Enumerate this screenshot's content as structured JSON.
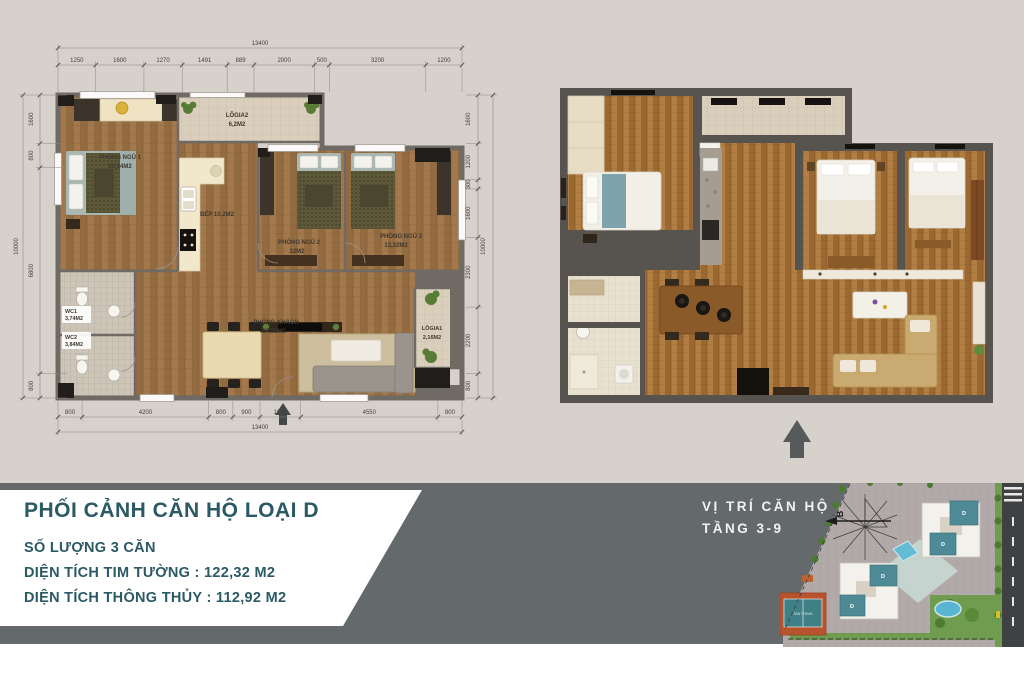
{
  "colors": {
    "canvas_bg": "#d7d1cc",
    "band": "#64696c",
    "title": "#2b5964",
    "wall_2d": "#6f6a64",
    "wall_3d": "#57534e",
    "unit_teal": "#4e8a96"
  },
  "plan2d": {
    "rooms": {
      "bedroom1": {
        "name": "PHÒNG NGỦ 1",
        "area": "20,14M2"
      },
      "logia2": {
        "name": "LÔGIA2",
        "area": "6,2M2"
      },
      "kitchen": {
        "name": "BẾP 10,2M2"
      },
      "bedroom2": {
        "name": "PHÒNG NGỦ 2",
        "area": "12M2"
      },
      "bedroom3": {
        "name": "PHÒNG NGỦ 3",
        "area": "13,32M2"
      },
      "wc1": {
        "name": "WC1",
        "area": "3,74M2"
      },
      "wc2": {
        "name": "WC2",
        "area": "3,84M2"
      },
      "living": {
        "name": "PHÒNG KHÁCH",
        "area": "37,52M2"
      },
      "logia1": {
        "name": "LÔGIA1",
        "area": "2,16M2"
      }
    },
    "dims": {
      "top": {
        "total": "13400",
        "segments": [
          "1250",
          "1600",
          "1270",
          "1491",
          "889",
          "2000",
          "500",
          "3200",
          "1200"
        ]
      },
      "bottom": {
        "total": "13400",
        "segments": [
          "800",
          "4200",
          "800",
          "900",
          "1350",
          "4550",
          "800"
        ]
      },
      "left": {
        "total": "10000",
        "segments": [
          "1600",
          "800",
          "6800",
          "800"
        ]
      },
      "right": {
        "total": "10000",
        "segments": [
          "1600",
          "1200",
          "300",
          "1600",
          "2300",
          "2200",
          "800"
        ]
      }
    }
  },
  "info_panel": {
    "title": "PHỐI CẢNH CĂN HỘ LOẠI D",
    "lines": [
      "SỐ LƯỢNG 3 CĂN",
      "DIỆN TÍCH TIM TƯỜNG : 122,32 M2",
      "DIỆN TÍCH THÔNG THỦY : 112,92 M2"
    ]
  },
  "location_panel": {
    "line1": "VỊ TRÍ CĂN HỘ",
    "line2": "TẦNG 3-9"
  },
  "site_map": {
    "compass_label": "B",
    "unit_labels": [
      "D",
      "D",
      "D",
      "D"
    ],
    "tennis_label": "SÂN TENNIS"
  }
}
